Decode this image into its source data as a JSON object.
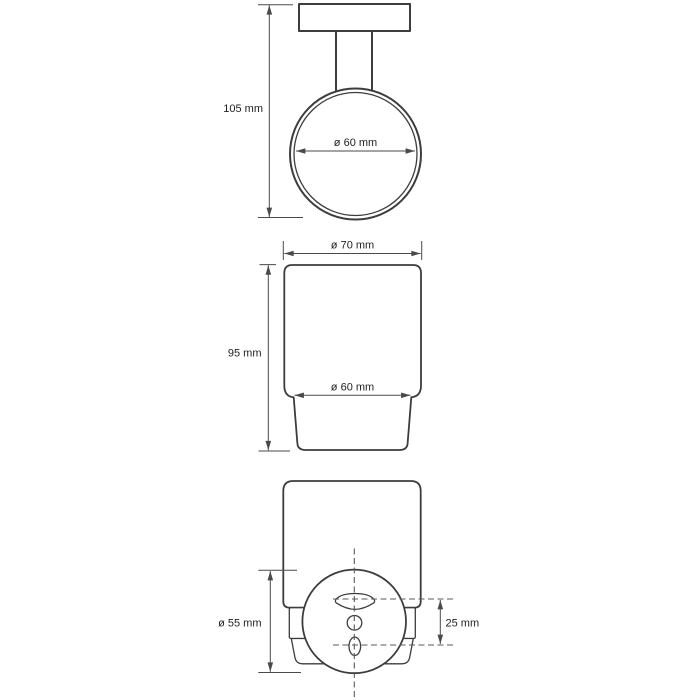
{
  "colors": {
    "background": "#ffffff",
    "line": "#3d3d3d",
    "dimension_line": "#4a4a4a",
    "centerline": "#5a5a5a",
    "text": "#1e1e1e"
  },
  "views": {
    "holder_front": {
      "dims": {
        "height": "105 mm",
        "ring_inner_diameter": "ø 60 mm"
      }
    },
    "tumbler_front": {
      "dims": {
        "top_diameter": "ø 70 mm",
        "height": "95 mm",
        "body_diameter": "ø 60 mm"
      }
    },
    "assembly_back": {
      "dims": {
        "plate_diameter": "ø 55 mm",
        "hole_spacing": "25 mm"
      }
    }
  }
}
